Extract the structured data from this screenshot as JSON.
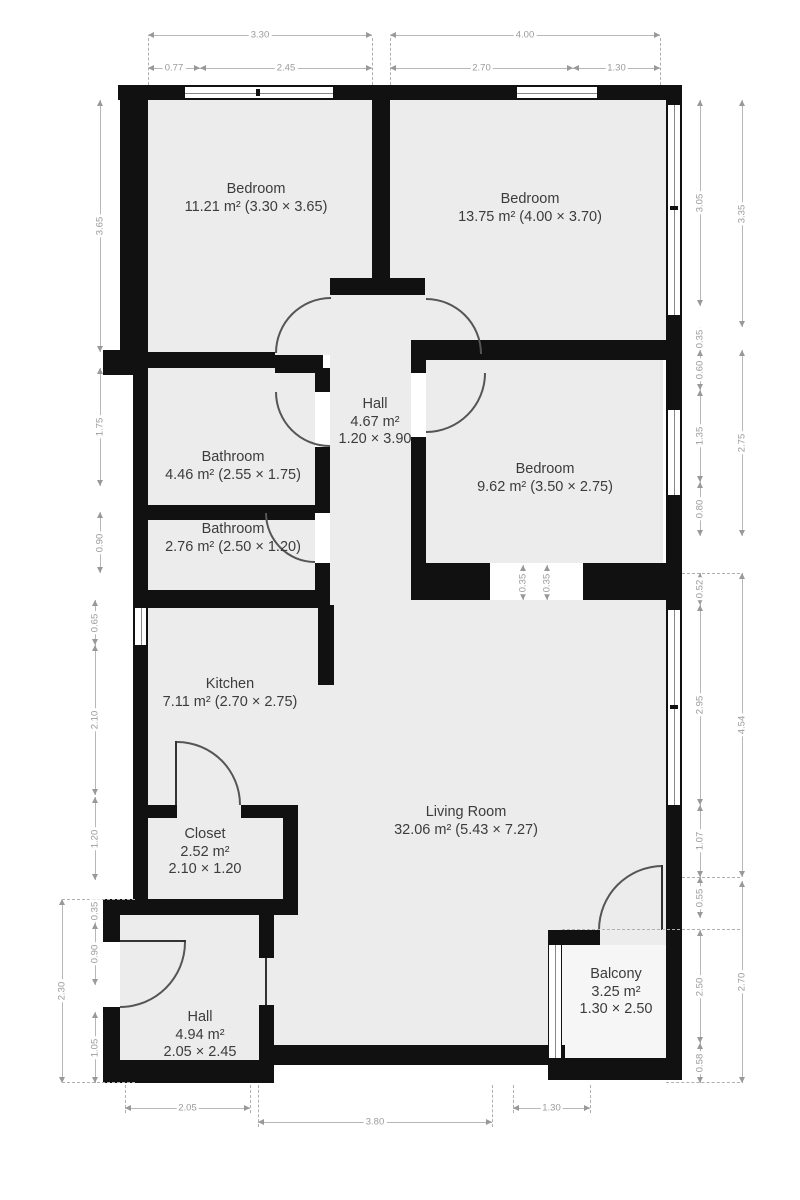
{
  "plan": {
    "kind": "apartment-floor-plan",
    "units": "m"
  },
  "rooms": [
    {
      "id": "bedroom-1",
      "lines": [
        "Bedroom",
        "11.21 m² (3.30 × 3.65)"
      ]
    },
    {
      "id": "bedroom-2",
      "lines": [
        "Bedroom",
        "13.75 m² (4.00 × 3.70)"
      ]
    },
    {
      "id": "hall-upper",
      "lines": [
        "Hall",
        "4.67 m²",
        "1.20 × 3.90"
      ]
    },
    {
      "id": "bathroom-1",
      "lines": [
        "Bathroom",
        "4.46 m² (2.55 × 1.75)"
      ]
    },
    {
      "id": "bathroom-2",
      "lines": [
        "Bathroom",
        "2.76 m² (2.50 × 1.20)"
      ]
    },
    {
      "id": "bedroom-3",
      "lines": [
        "Bedroom",
        "9.62 m² (3.50 × 2.75)"
      ]
    },
    {
      "id": "kitchen",
      "lines": [
        "Kitchen",
        "7.11 m² (2.70 × 2.75)"
      ]
    },
    {
      "id": "living-room",
      "lines": [
        "Living Room",
        "32.06 m² (5.43 × 7.27)"
      ]
    },
    {
      "id": "closet",
      "lines": [
        "Closet",
        "2.52 m²",
        "2.10 × 1.20"
      ]
    },
    {
      "id": "hall-lower",
      "lines": [
        "Hall",
        "4.94 m²",
        "2.05 × 2.45"
      ]
    },
    {
      "id": "balcony",
      "lines": [
        "Balcony",
        "3.25 m²",
        "1.30 × 2.50"
      ]
    }
  ],
  "dims": {
    "top": [
      "3.30",
      "4.00",
      "0.77",
      "2.45",
      "2.70",
      "1.30"
    ],
    "bottom": [
      "2.05",
      "3.80",
      "1.30"
    ],
    "left": [
      "3.65",
      "1.75",
      "0.90",
      "0.65",
      "2.10",
      "1.20",
      "0.35",
      "0.90",
      "1.05",
      "2.30"
    ],
    "right_inner": [
      "3.05",
      "0.35",
      "0.60",
      "1.35",
      "0.80",
      "0.52",
      "2.95",
      "1.07",
      "0.55",
      "2.50",
      "0.58"
    ],
    "right_outer": [
      "3.35",
      "2.75",
      "4.54",
      "2.70"
    ],
    "middle": [
      "0.35",
      "0.35"
    ]
  },
  "colors": {
    "wall": "#111111",
    "floor": "#ececec",
    "dimension": "#9a9a9a",
    "label": "#3c3c3c"
  }
}
